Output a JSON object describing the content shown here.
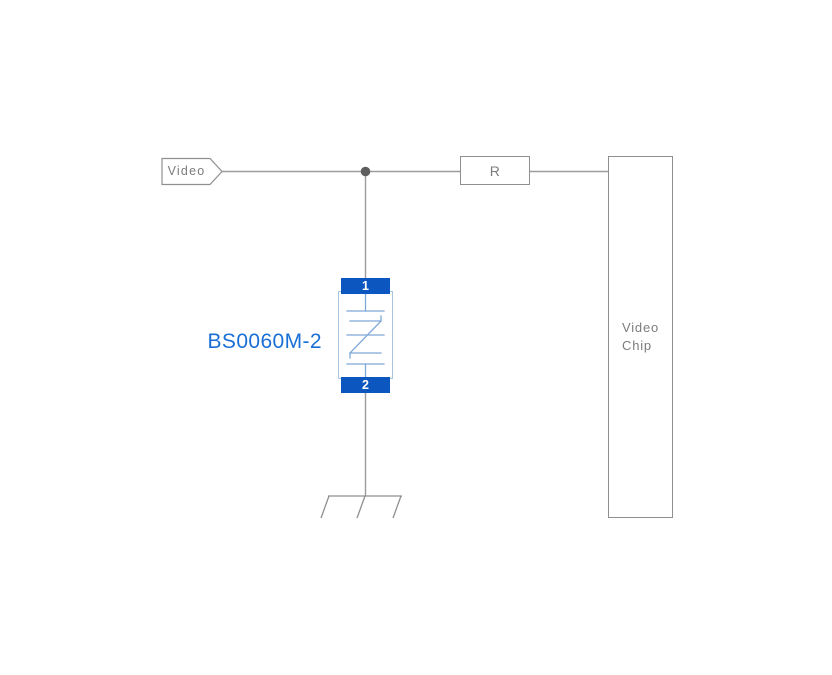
{
  "colors": {
    "background": "#ffffff",
    "wire": "#9c9c9c",
    "box_border": "#8f8f8f",
    "junction_dot": "#5e5e5e",
    "gray_text": "#7c7c7c",
    "tvs_pin_fill": "#0c57bf",
    "tvs_pin_text": "#ffffff",
    "tvs_body_outline": "#a9c4e3",
    "tvs_symbol_stroke": "#7fa7d7",
    "part_label_text": "#1a6fd6"
  },
  "diagram": {
    "port": {
      "label": "Video"
    },
    "series_resistor": {
      "label": "R"
    },
    "chip": {
      "label_line1": "Video",
      "label_line2": "Chip"
    },
    "tvs": {
      "part_number": "BS0060M-2",
      "pin_top": "1",
      "pin_bottom": "2"
    }
  }
}
